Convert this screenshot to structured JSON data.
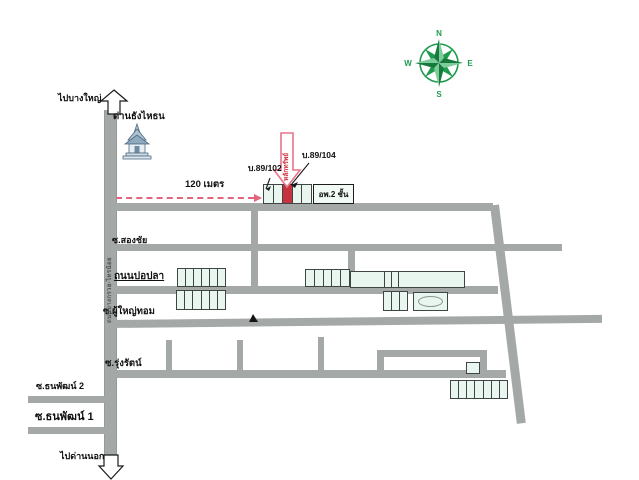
{
  "labels": {
    "to_top": "ไปบางใหญ่",
    "temple": "ด่านธังไหธน",
    "house_a": "บ.89/102",
    "house_b": "บ.89/104",
    "collateral": "หลักทรัพย์",
    "distance": "120 เมตร",
    "apartment": "อพ.2 ชั้น",
    "soi_songchai": "ซ.สองชัย",
    "road_popla": "ถนนปอปลา",
    "soi_phuyaitom": "ซ.ผู้ใหญ่ทอม",
    "soi_rungrat": "ซ.รุ่งรัตน์",
    "soi_thanaphat_2": "ซ.ธนพัฒน์ 2",
    "soi_thanaphat_1": "ซ.ธนพัฒน์ 1",
    "to_bottom": "ไปด่านนอก",
    "main_road": "ถนนบางกรวย-ไทรน้อย"
  },
  "compass": {
    "n": "N",
    "e": "E",
    "s": "S",
    "w": "W"
  },
  "buildings": {
    "property_row_units": 5,
    "property_red_index": 2,
    "cluster_a_top_units": 6,
    "cluster_a_bottom_units": 6,
    "cluster_b_units": 5,
    "block_c_units": 3,
    "bottom_row_units": 7
  },
  "colors": {
    "road": "#a4a9a7",
    "building_fill": "#e9f5ef",
    "building_border": "#3f4542",
    "highlight_red": "#c53240",
    "arrow_pink": "#e8758a",
    "compass_green": "#1e9b4d"
  }
}
